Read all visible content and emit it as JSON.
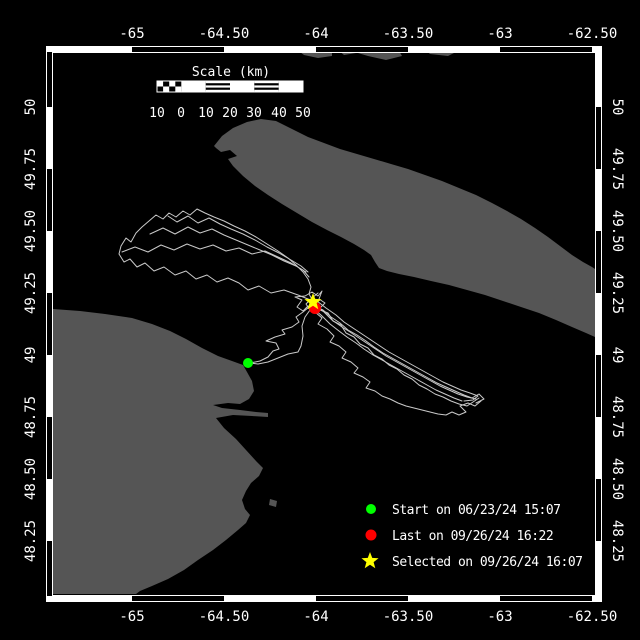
{
  "colors": {
    "background": "#000000",
    "land": "#555555",
    "track": "#c9c9c9",
    "frame": "#ffffff",
    "start_marker": "#00ff00",
    "last_marker": "#ff0000",
    "selected_marker": "#ffff00"
  },
  "axes": {
    "top": [
      "-65",
      "-64.50",
      "-64",
      "-63.50",
      "-63",
      "-62.50"
    ],
    "bottom": [
      "-65",
      "-64.50",
      "-64",
      "-63.50",
      "-63",
      "-62.50"
    ],
    "left": [
      "50",
      "49.75",
      "49.50",
      "49.25",
      "49",
      "48.75",
      "48.50",
      "48.25"
    ],
    "right": [
      "50",
      "49.75",
      "49.50",
      "49.25",
      "49",
      "48.75",
      "48.50",
      "48.25"
    ]
  },
  "scalebar": {
    "title": "Scale (km)",
    "labels": [
      "10",
      "0",
      "10",
      "20",
      "30",
      "40",
      "50"
    ]
  },
  "legend": {
    "items": [
      {
        "label": "Start on 06/23/24 15:07"
      },
      {
        "label": "Last on 09/26/24 16:22"
      },
      {
        "label": "Selected on 09/26/24 16:07"
      }
    ]
  },
  "map": {
    "land": {
      "gaspe": "53,309 80,311 105,314 132,318 152,324 170,331 186,339 202,348 218,356 232,361 243,365 247,372 252,381 254,391 249,399 240,404 228,403 213,405 222,408 240,410 256,412 268,413 268,417 252,416 233,415 216,418 224,428 236,439 246,450 256,461 263,468 259,476 251,483 246,491 242,500 245,509 250,515 246,523 238,530 226,540 213,550 198,560 184,570 168,579 152,586 140,591 136,594 53,594",
      "gaspe_island": "270,499 277,501 276,507 269,505",
      "anticosti": "214,146 222,136 233,128 247,122 261,119 276,121 292,129 308,137 324,143 340,149 357,154 374,159 391,164 408,169 425,175 442,181 459,188 476,195 492,203 507,211 521,219 535,228 548,237 560,246 572,255 583,262 592,267 595,269 595,337 586,333 572,327 556,320 539,313 521,307 503,301 485,295 467,290 449,285 431,281 414,277 399,274 387,271 379,268 375,262 371,255 364,250 354,244 341,237 327,230 312,222 297,213 282,204 268,195 255,186 243,176 233,166 228,159 237,156 230,150 221,152 216,148",
      "north_shore": [
        "300,50 332,49 332,56 318,58 304,55 300,52",
        "338,50 352,48 356,53 344,55",
        "358,49 380,47 398,49 402,56 386,60 368,56 358,53",
        "406,49 416,47 420,52 410,53",
        "424,49 452,47 458,51 448,56 430,54",
        "462,48 468,47 470,51 464,52"
      ]
    },
    "tracks": [
      "313,301 298,295 284,290 271,293 259,286 248,290 239,283 228,278 217,282 207,275 196,279 186,271 175,275 164,267 154,271 145,263 137,267 130,259 124,262 119,254 121,246 126,238 131,242 136,233 142,227 149,221 156,215 163,219 169,213 176,217 183,211 190,215 197,209 205,213 214,217 224,221 234,226 245,231 256,237 267,244 278,251 288,258 296,265 303,272 308,279 311,287 309,294 313,301",
      "122,252 135,247 148,252 161,245 174,250 187,244 200,249 213,245 226,251 239,248 252,254 265,251 278,257 291,263 303,270 309,277",
      "150,234 163,228 175,234 188,227 200,233 212,229 224,235 236,240 248,245 260,250 272,255 284,261 296,266 306,272",
      "168,216 177,222 188,216 198,223 209,218 220,224 231,229 243,234 255,240 267,247 279,253 291,260 301,266 308,272",
      "318,293 312,298 306,304 310,310 305,317 302,326 303,336 301,346 298,352 288,354 278,358 268,362 258,364 250,363",
      "250,363 260,361 268,357 273,351 279,349 276,343 266,341 275,337 285,334 282,330 292,327 299,322 296,317 303,312 309,307 314,303",
      "315,305 324,312 332,320 342,327 350,332 359,338 368,344 377,350 386,356 395,361 404,366 413,371 422,376 431,381 440,386 449,390 458,394 467,397 476,399",
      "317,301 326,308 336,315 344,322 353,328 362,334 371,340 380,346 389,352 398,357 407,362 416,367 425,372 434,377 443,382 452,386 461,390 470,393 478,396 473,400 464,401",
      "313,308 322,316 330,324 339,331 347,337 356,343 364,349 373,355 382,360 391,365 400,370 409,375 418,380 427,385 436,390 445,394 454,398 462,401",
      "316,303 320,310 328,313 333,321 341,325 346,333 354,337 360,344 368,348 374,355 382,359 389,365 397,369 404,375 412,379 419,385 427,389 435,394 443,397 451,401 459,404 467,406 473,402 479,398",
      "314,306 323,310 331,317 340,323 348,330 357,335 366,341 374,347 383,353 392,358 401,363 410,368 419,373 428,378 437,383 446,387 455,391 464,395 472,398 479,394 484,399 476,403",
      "318,306 315,312 322,318 318,324 327,329 334,336 330,342 339,346 346,352 342,358 351,362 358,368 354,373 363,377 370,382 366,388 375,391 382,396 390,399 398,403 406,406 414,408 422,410 430,412 438,414 446,415 452,412 459,415 466,412 460,406 468,403 475,406 481,401",
      "305,296 312,292 318,296 322,291 319,299 325,303 320,308 314,311 308,306 303,311 297,307 302,300 295,297 305,296"
    ],
    "markers": {
      "start": {
        "transform": "translate(248,363)"
      },
      "last": {
        "transform": "translate(315,308)"
      },
      "selected": {
        "transform": "translate(313,302)"
      }
    },
    "star_path": "M0,-9 L2.23,-3.07 L8.56,-2.78 L3.61,1.17 L5.29,7.28 L0,3.8 L-5.29,7.28 L-3.61,1.17 L-8.56,-2.78 L-2.23,-3.07 Z"
  }
}
